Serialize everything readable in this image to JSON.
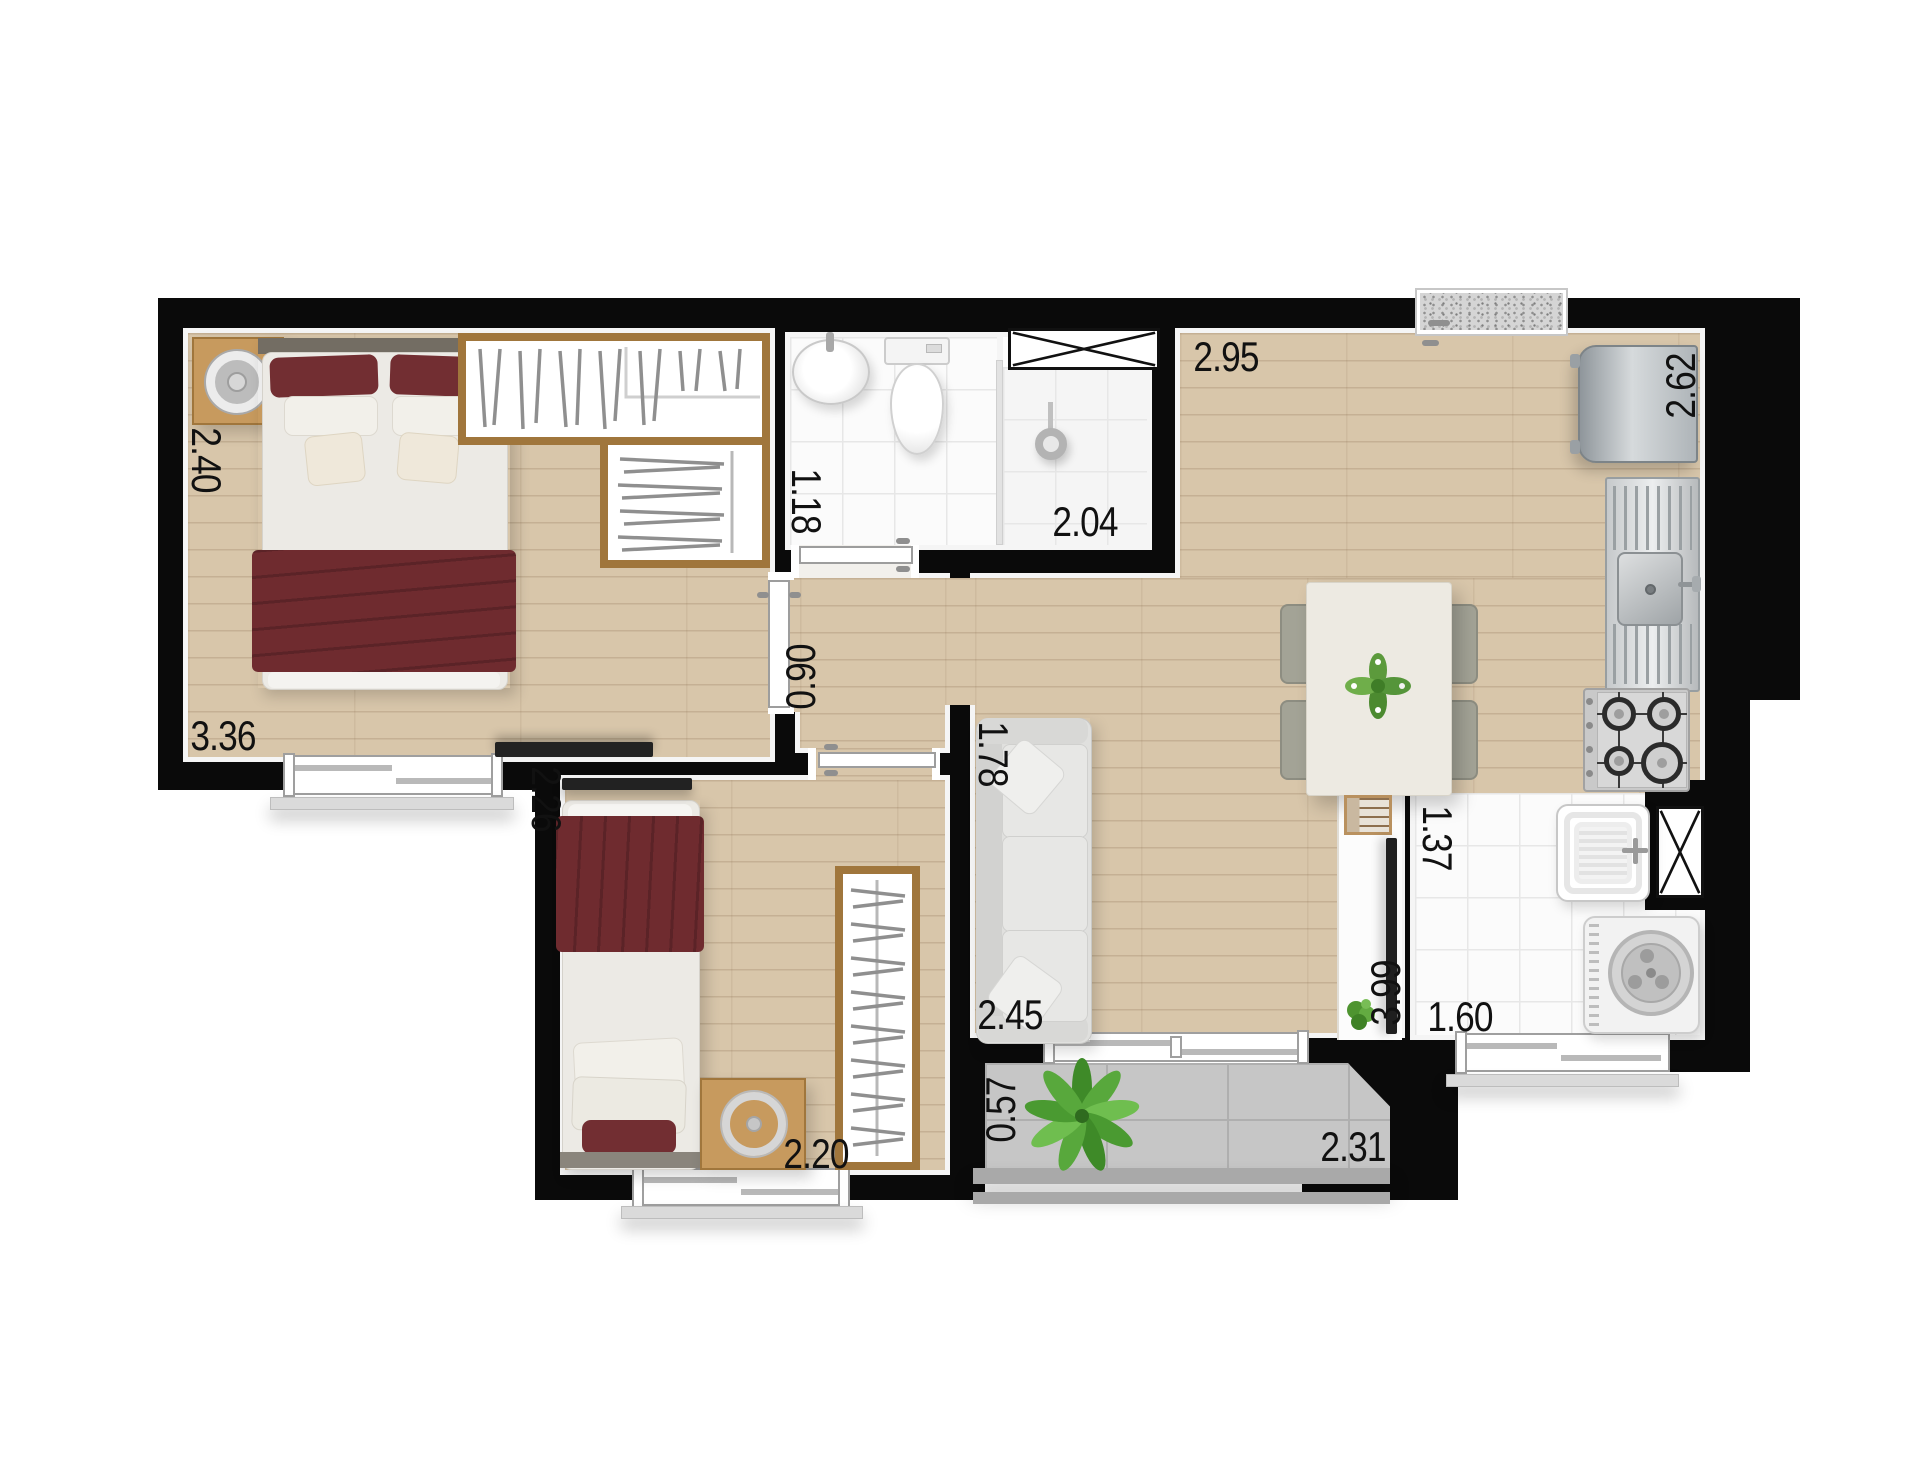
{
  "dimensions": {
    "master_depth": "2.40",
    "master_width": "3.36",
    "bath_width": "1.18",
    "bath_total_width": "2.04",
    "hall_width": "0.90",
    "living_top_width": "2.95",
    "kitchen_wall_length": "2.62",
    "bedroom2_depth": "2.26",
    "bedroom2_width": "2.20",
    "sofa_wall_length": "1.78",
    "living_bottom_width": "2.45",
    "living_length": "3.99",
    "laundry_depth": "1.37",
    "laundry_width": "1.60",
    "balcony_depth": "0.57",
    "balcony_width": "2.31"
  },
  "colors": {
    "wall": "#0a0a0a",
    "wood_floor": "#d8c6aa",
    "tile_floor": "#fbfbfb",
    "balcony_floor": "#c6c6c6",
    "bedding_accent": "#6f2b2f",
    "wood_furniture": "#c79a5e",
    "label_text": "#111111"
  }
}
